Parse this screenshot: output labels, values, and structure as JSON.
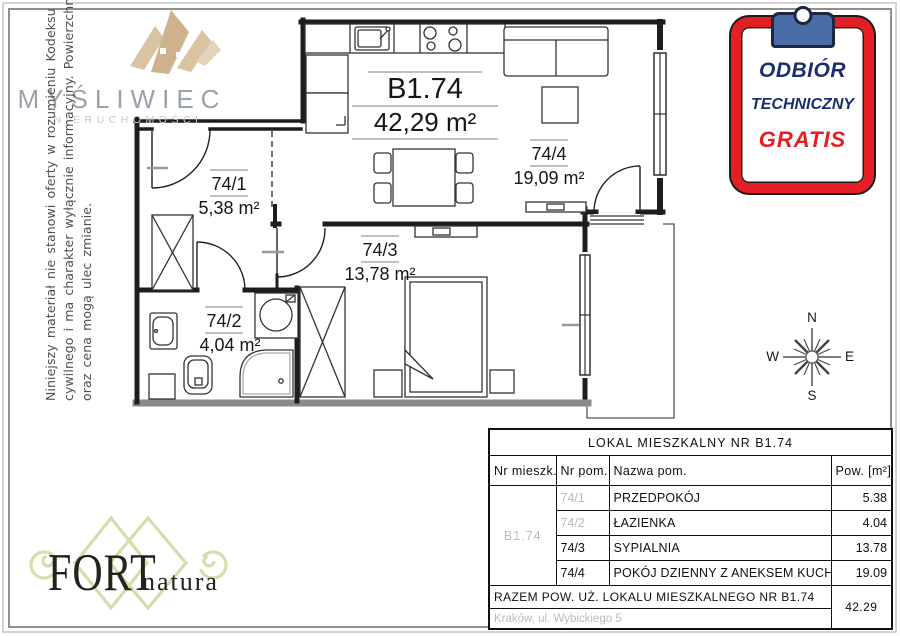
{
  "branding": {
    "agency_name": "MYŚLIWIEC",
    "agency_subtitle": "NIERUCHOMOŚCI",
    "developer_name": "FORT",
    "developer_suffix": "natura"
  },
  "disclaimer": {
    "line1": "Niniejszy materiał nie stanowi oferty w rozumieniu Kodeksu",
    "line2": "cywilnego i ma charakter wyłącznie informacyjny. Powierzchnia",
    "line3": "oraz cena mogą ulec zmianie."
  },
  "stamp": {
    "line1": "ODBIÓR",
    "line2": "TECHNICZNY",
    "line3": "GRATIS"
  },
  "compass": {
    "north": "N",
    "south": "S",
    "east": "E",
    "west": "W"
  },
  "plan": {
    "unit_label": "B1.74",
    "unit_area": "42,29 m²",
    "rooms": [
      {
        "id": "74/1",
        "area": "5,38 m²"
      },
      {
        "id": "74/2",
        "area": "4,04 m²"
      },
      {
        "id": "74/3",
        "area": "13,78 m²"
      },
      {
        "id": "74/4",
        "area": "19,09 m²"
      }
    ]
  },
  "table": {
    "title": "LOKAL MIESZKALNY NR B1.74",
    "headers": {
      "unit": "Nr mieszk.",
      "room_no": "Nr pom.",
      "room_name": "Nazwa pom.",
      "area": "Pow. [m²]"
    },
    "unit_id": "B1.74",
    "rows": [
      {
        "no": "74/1",
        "name": "PRZEDPOKÓJ",
        "area": "5.38"
      },
      {
        "no": "74/2",
        "name": "ŁAZIENKA",
        "area": "4.04"
      },
      {
        "no": "74/3",
        "name": "SYPIALNIA",
        "area": "13.78"
      },
      {
        "no": "74/4",
        "name": "POKÓJ DZIENNY Z ANEKSEM KUCHENNYM",
        "area": "19.09"
      }
    ],
    "total_label": "RAZEM POW. UŻ. LOKALU MIESZKALNEGO NR B1.74",
    "total_area": "42.29",
    "address": "Kraków, ul. Wybickiego 5"
  },
  "colors": {
    "stamp_red": "#e31e24",
    "stamp_navy": "#1b2f6e",
    "clip_blue": "#4a6da7",
    "logo_beige": "#d9c3a2",
    "logo_gray": "#9aa2ac",
    "fort_olive": "#d7dcaa",
    "muted_gray": "#bcbcbc"
  }
}
